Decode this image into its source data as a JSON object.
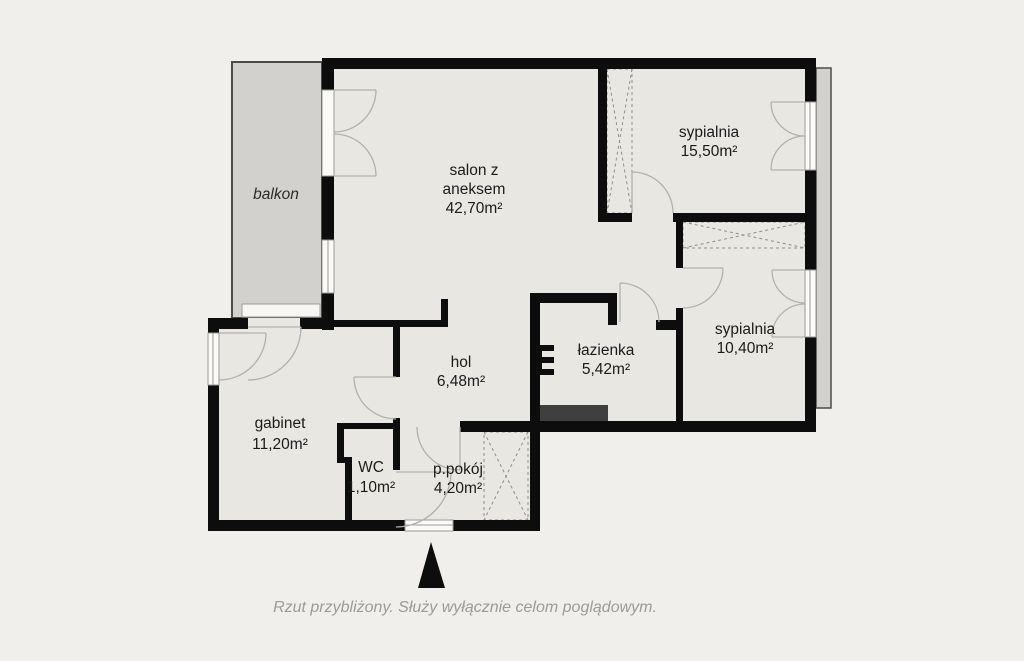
{
  "plan": {
    "type": "apartment-floor-plan",
    "rooms": {
      "balkon": {
        "name": "balkon"
      },
      "salon": {
        "name_line1": "salon z",
        "name_line2": "aneksem",
        "area": "42,70m²"
      },
      "sypialnia_duza": {
        "name": "sypialnia",
        "area": "15,50m²"
      },
      "sypialnia_mala": {
        "name": "sypialnia",
        "area": "10,40m²"
      },
      "lazienka": {
        "name": "łazienka",
        "area": "5,42m²"
      },
      "hol": {
        "name": "hol",
        "area": "6,48m²"
      },
      "gabinet": {
        "name": "gabinet",
        "area": "11,20m²"
      },
      "wc": {
        "name": "WC",
        "area": "1,10m²"
      },
      "przedpokoj": {
        "name": "p.pokój",
        "area": "4,20m²"
      }
    }
  },
  "footer": {
    "disclaimer": "Rzut przybliżony. Służy wyłącznie celom poglądowym."
  },
  "colors": {
    "background": "#f0efeb",
    "floor": "#e9e7e2",
    "balcony_fill": "#d2d1cd",
    "wall": "#0d0d0d",
    "fixture_dark": "#3f3f3f",
    "door_arc": "#b2b1ae",
    "label_text": "#1b1b1b",
    "disclaimer_text": "#9b9b99"
  }
}
